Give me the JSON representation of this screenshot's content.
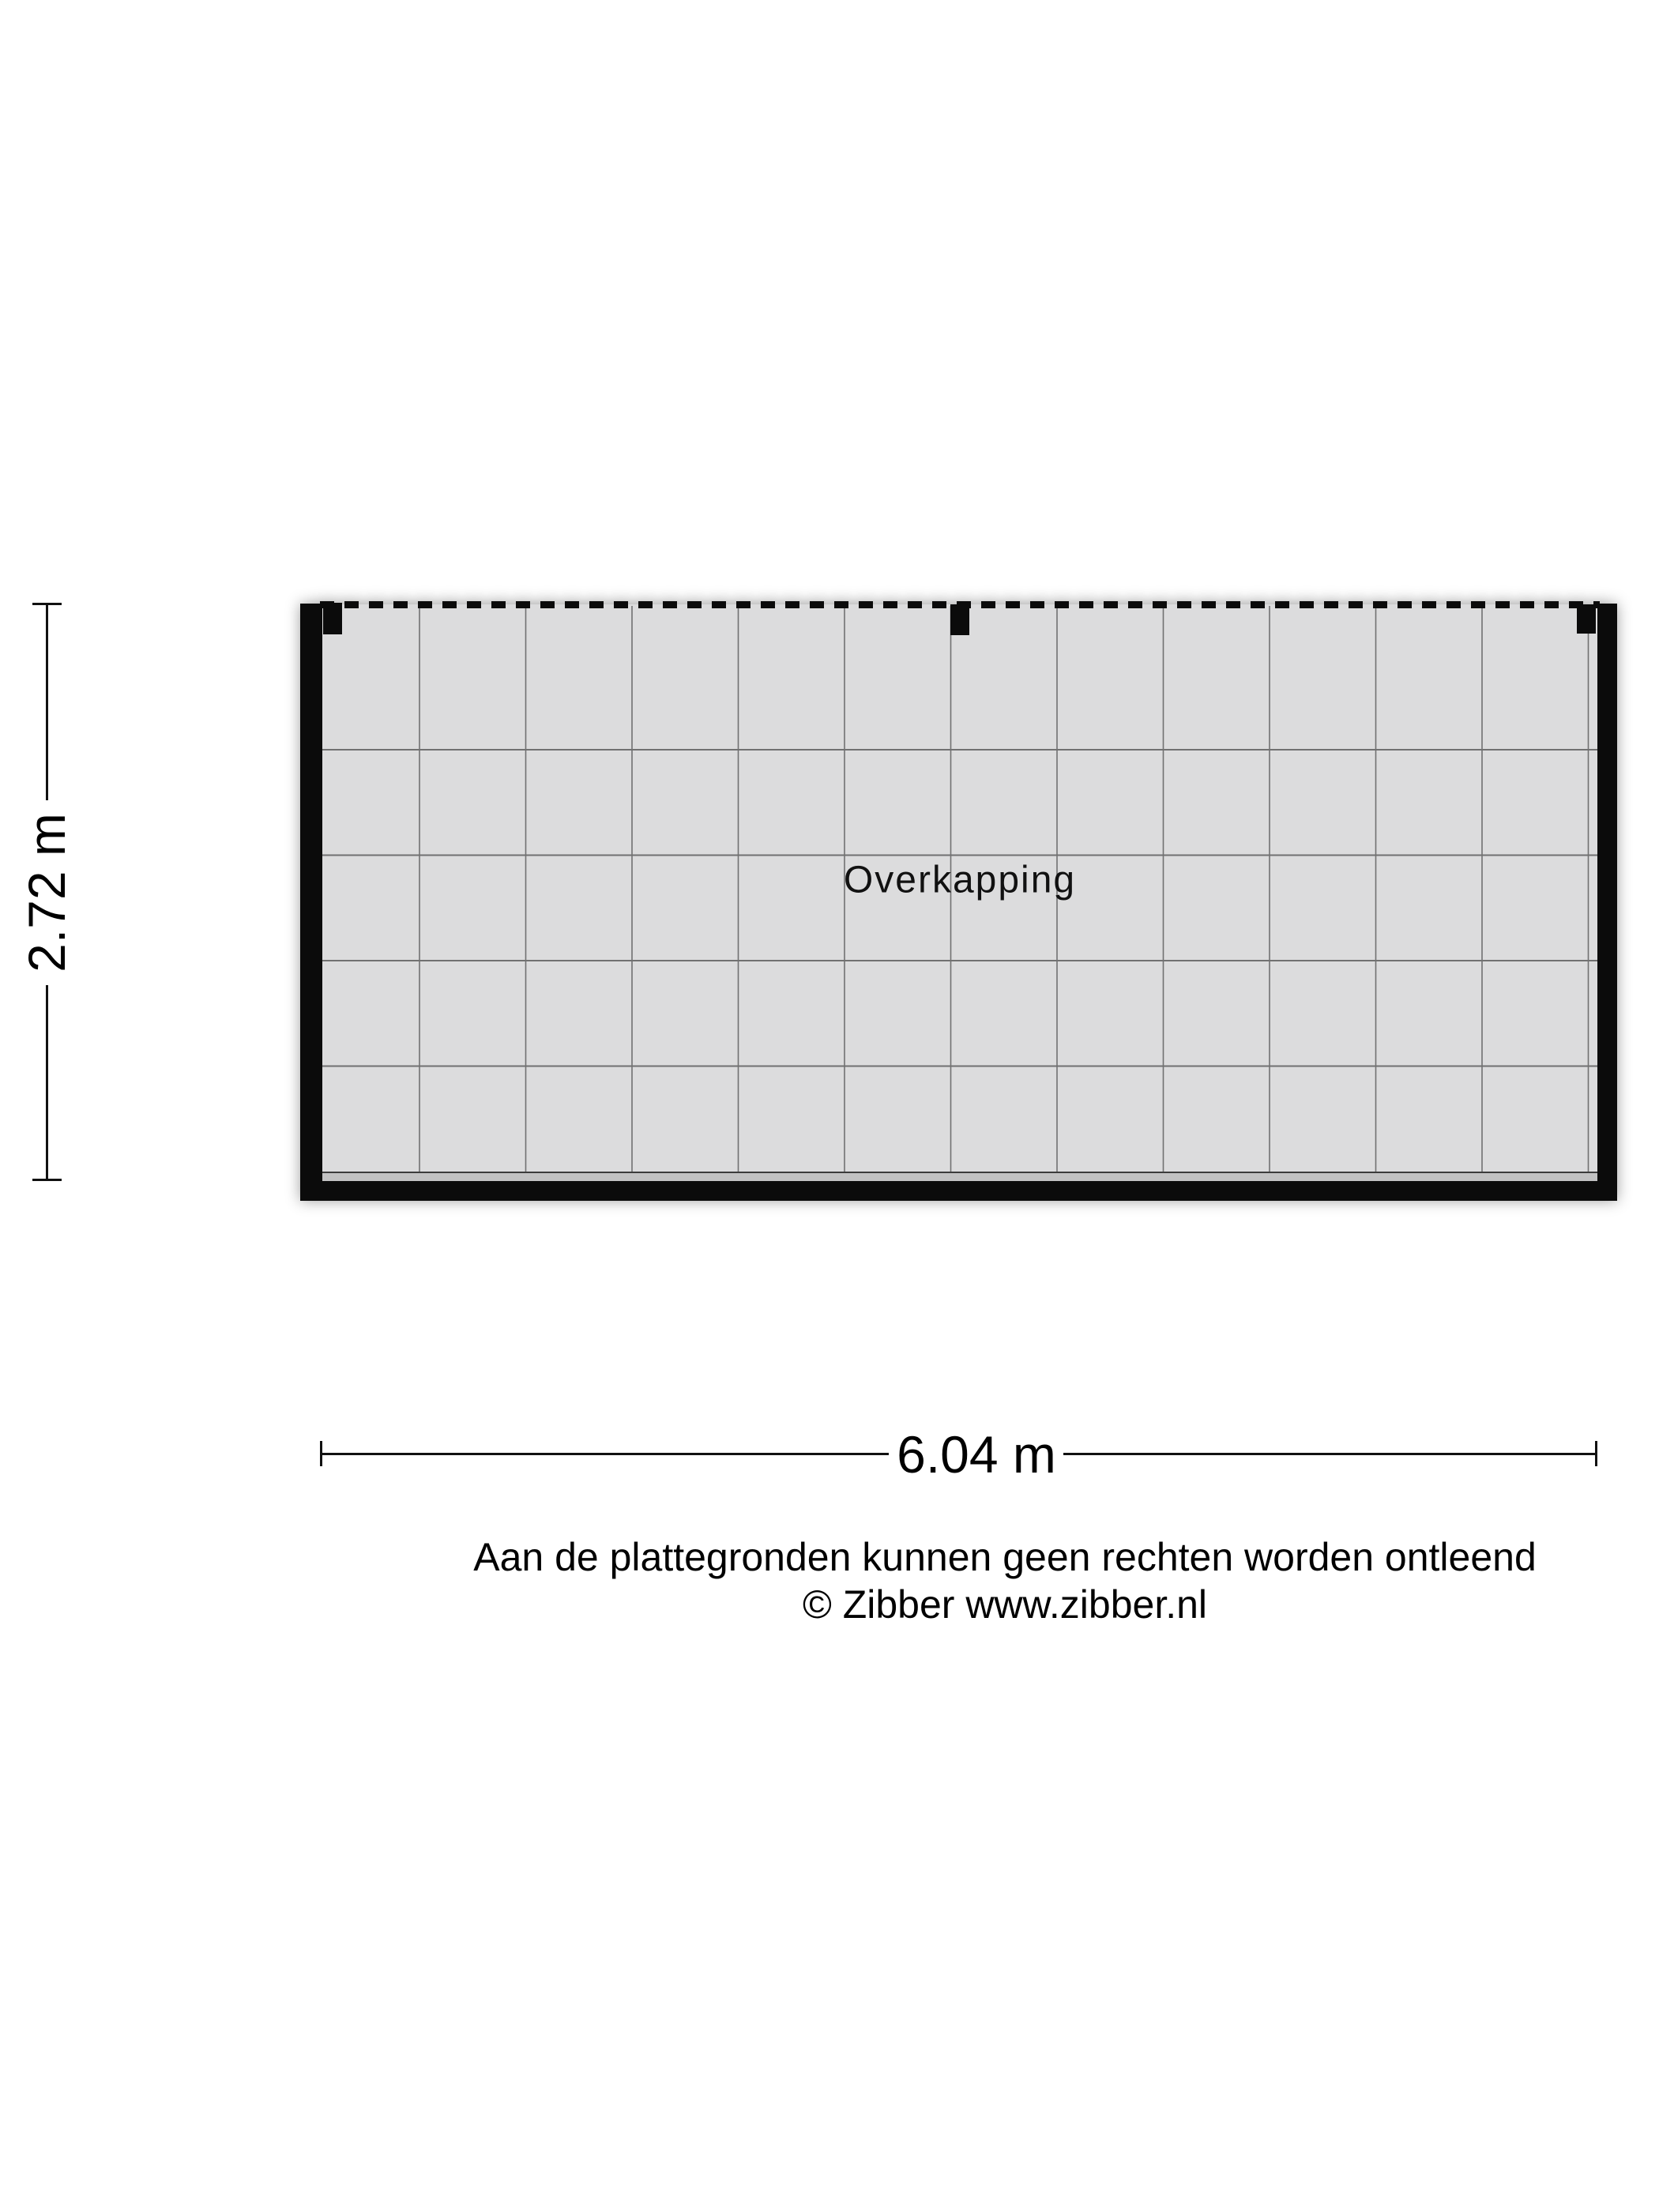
{
  "floorplan": {
    "room_label": "Overkapping",
    "height_dimension_label": "2.72 m",
    "width_dimension_label": "6.04 m",
    "grid": {
      "columns": 12,
      "row_lines": 4
    },
    "colors": {
      "floor": "#dcdcdd",
      "floor_strip": "#c2c2c3",
      "strip_line": "#3c3c3c",
      "tile_line": "#5f5f5f",
      "wall": "#0b0b0b",
      "dashed_edge": "#0b0b0b",
      "dimension": "#111111"
    }
  },
  "footer": {
    "disclaimer": "Aan de plattegronden kunnen geen rechten worden ontleend",
    "copyright": "© Zibber www.zibber.nl"
  }
}
